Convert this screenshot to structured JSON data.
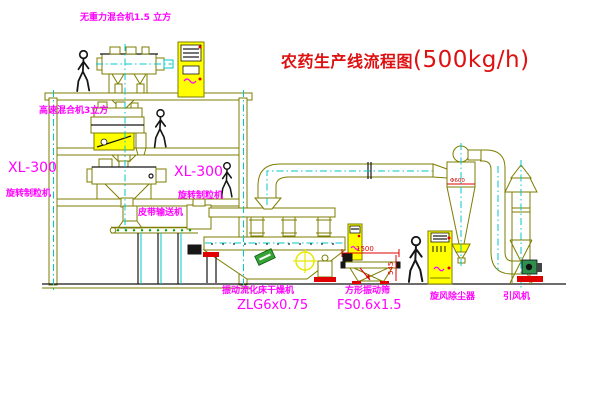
{
  "title": {
    "text": "农药生产线流程图",
    "capacity": "(500kg/h)"
  },
  "labels": {
    "gravity_mixer": "无重力混合机1.5 立方",
    "high_speed_mixer": "高速混合机3立方",
    "xl300_left_model": "XL-300",
    "xl300_left_name": "旋转制粒机",
    "xl300_mid_model": "XL-300",
    "xl300_mid_name": "旋转制粒机",
    "belt_conveyor": "皮带输送机",
    "dryer_name": "振动流化床干燥机",
    "dryer_model": "ZLG6x0.75",
    "sieve_name": "方形振动筛",
    "sieve_model": "FS0.6x1.5",
    "cyclone_name": "旋风除尘器",
    "fan_name": "引风机"
  },
  "dimensions": {
    "sieve_length": "1500",
    "sieve_height": "545",
    "cyclone_diameter": "Φ600"
  },
  "colors": {
    "line": "#7d7d00",
    "centerline": "#00c8c8",
    "label": "#ff00ff",
    "title": "#dd1111",
    "dimension": "#e00000",
    "cabinet_fill": "#ffff00"
  }
}
